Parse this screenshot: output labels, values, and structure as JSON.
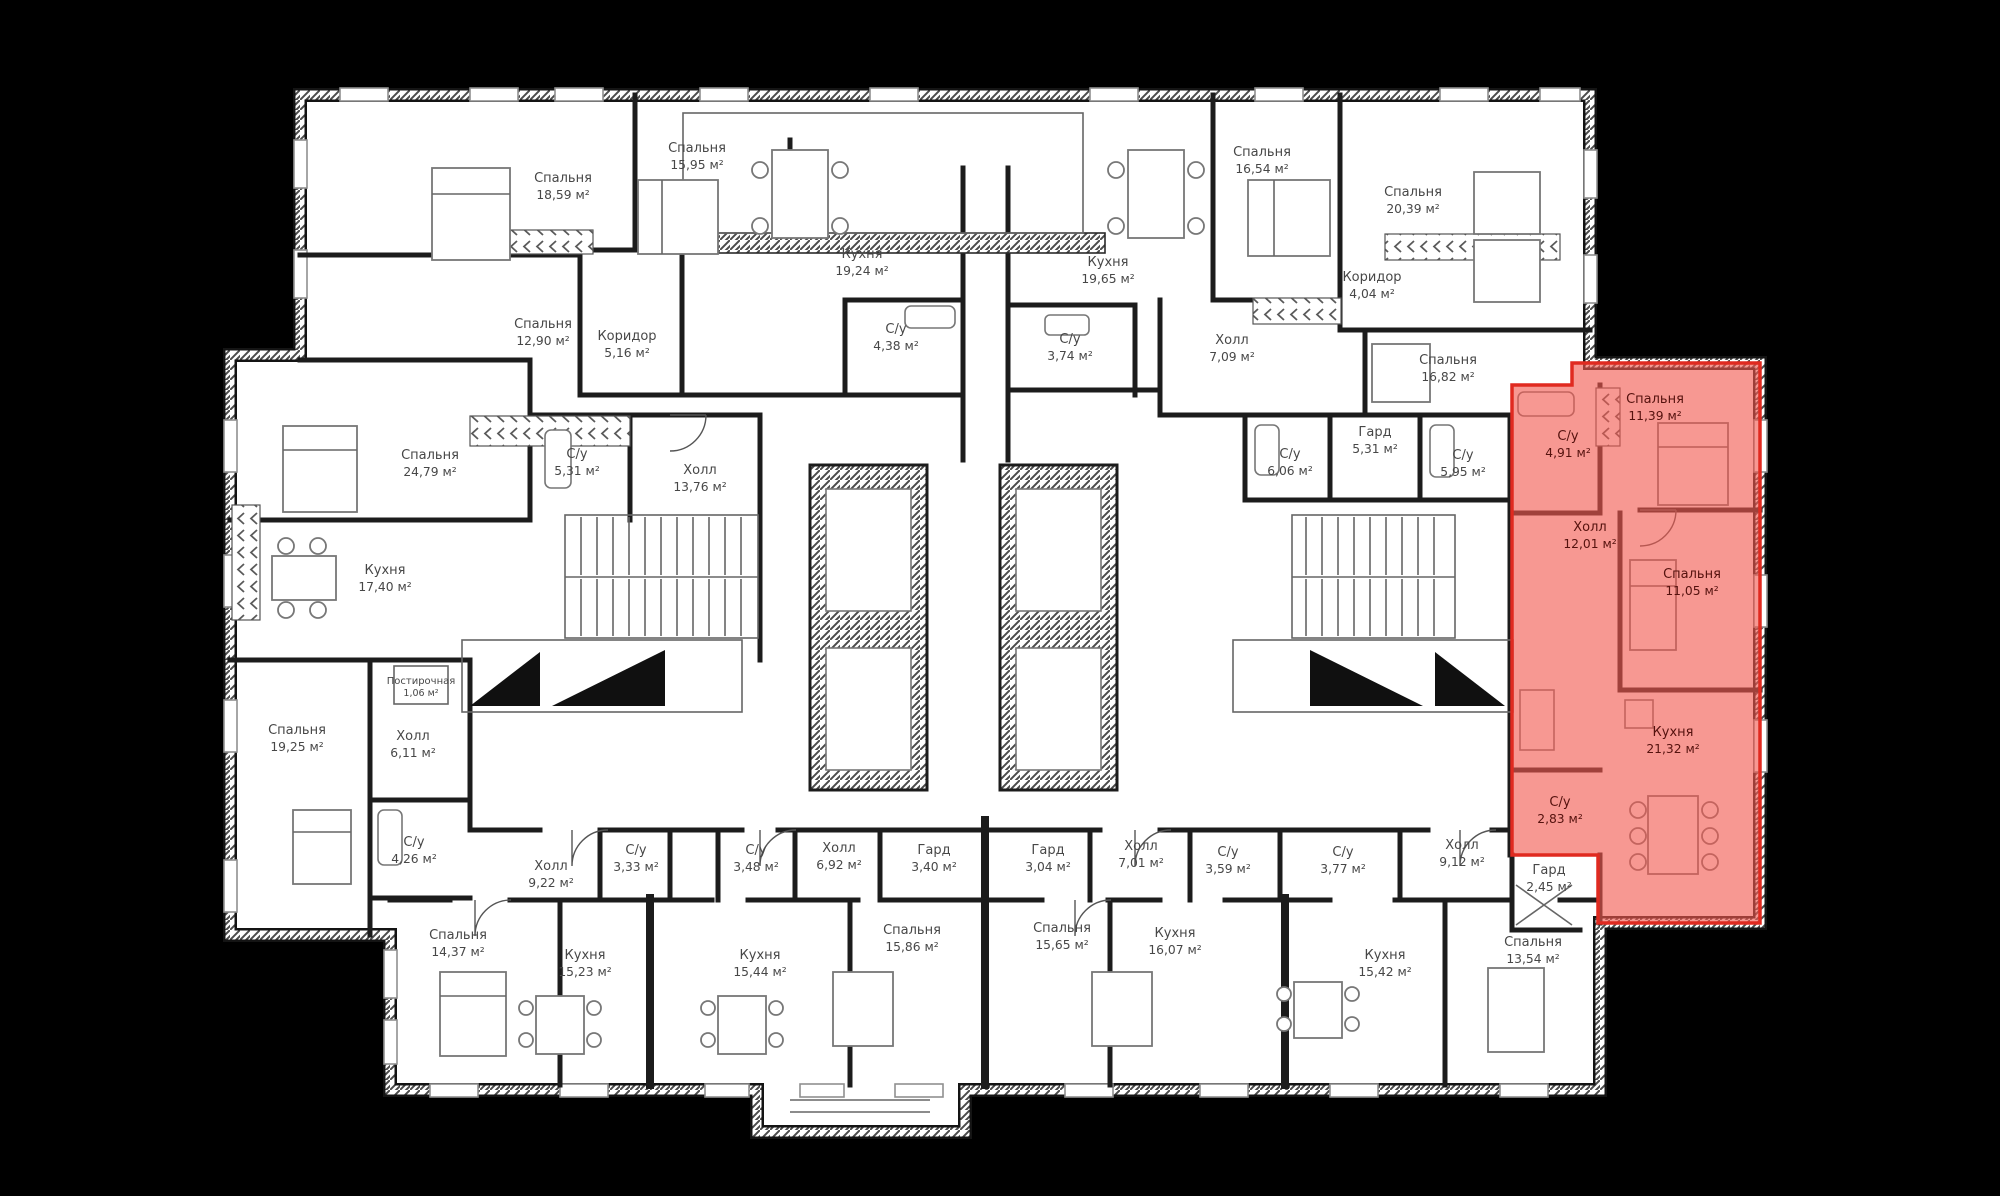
{
  "background": "#000000",
  "building_fill": "#ffffff",
  "wall_color": "#1c1c1c",
  "highlight": {
    "fill": "#f2584f",
    "border": "#e02a20"
  },
  "unit_suffix": "м²",
  "rooms": [
    {
      "name": "Спальня",
      "area": "18,59",
      "x": 563,
      "y": 182
    },
    {
      "name": "Спальня",
      "area": "15,95",
      "x": 697,
      "y": 152
    },
    {
      "name": "Кухня",
      "area": "19,24",
      "x": 862,
      "y": 258
    },
    {
      "name": "Спальня",
      "area": "12,90",
      "x": 543,
      "y": 328
    },
    {
      "name": "Коридор",
      "area": "5,16",
      "x": 627,
      "y": 340
    },
    {
      "name": "С/у",
      "area": "4,38",
      "x": 896,
      "y": 333
    },
    {
      "name": "С/у",
      "area": "3,74",
      "x": 1070,
      "y": 343
    },
    {
      "name": "Кухня",
      "area": "19,65",
      "x": 1108,
      "y": 266
    },
    {
      "name": "Спальня",
      "area": "16,54",
      "x": 1262,
      "y": 156
    },
    {
      "name": "Спальня",
      "area": "20,39",
      "x": 1413,
      "y": 196
    },
    {
      "name": "Коридор",
      "area": "4,04",
      "x": 1372,
      "y": 281
    },
    {
      "name": "Холл",
      "area": "7,09",
      "x": 1232,
      "y": 344
    },
    {
      "name": "Спальня",
      "area": "16,82",
      "x": 1448,
      "y": 364
    },
    {
      "name": "Спальня",
      "area": "24,79",
      "x": 430,
      "y": 459
    },
    {
      "name": "С/у",
      "area": "5,31",
      "x": 577,
      "y": 458
    },
    {
      "name": "Холл",
      "area": "13,76",
      "x": 700,
      "y": 474
    },
    {
      "name": "Кухня",
      "area": "17,40",
      "x": 385,
      "y": 574
    },
    {
      "name": "Гард",
      "area": "5,31",
      "x": 1375,
      "y": 436
    },
    {
      "name": "С/у",
      "area": "6,06",
      "x": 1290,
      "y": 458
    },
    {
      "name": "С/у",
      "area": "5,95",
      "x": 1463,
      "y": 459
    },
    {
      "name": "Спальня",
      "area": "19,25",
      "x": 297,
      "y": 734
    },
    {
      "name": "Холл",
      "area": "6,11",
      "x": 413,
      "y": 740
    },
    {
      "name": "Постирочная",
      "area": "1,06",
      "x": 421,
      "y": 684,
      "small": true
    },
    {
      "name": "С/у",
      "area": "4,26",
      "x": 414,
      "y": 846
    },
    {
      "name": "Холл",
      "area": "9,22",
      "x": 551,
      "y": 870
    },
    {
      "name": "С/у",
      "area": "3,33",
      "x": 636,
      "y": 854
    },
    {
      "name": "С/у",
      "area": "3,48",
      "x": 756,
      "y": 854
    },
    {
      "name": "Холл",
      "area": "6,92",
      "x": 839,
      "y": 852
    },
    {
      "name": "Гард",
      "area": "3,40",
      "x": 934,
      "y": 854
    },
    {
      "name": "Гард",
      "area": "3,04",
      "x": 1048,
      "y": 854
    },
    {
      "name": "Холл",
      "area": "7,01",
      "x": 1141,
      "y": 850
    },
    {
      "name": "С/у",
      "area": "3,59",
      "x": 1228,
      "y": 856
    },
    {
      "name": "С/у",
      "area": "3,77",
      "x": 1343,
      "y": 856
    },
    {
      "name": "Холл",
      "area": "9,12",
      "x": 1462,
      "y": 849
    },
    {
      "name": "Гард",
      "area": "2,45",
      "x": 1549,
      "y": 874
    },
    {
      "name": "Спальня",
      "area": "14,37",
      "x": 458,
      "y": 939
    },
    {
      "name": "Кухня",
      "area": "15,23",
      "x": 585,
      "y": 959
    },
    {
      "name": "Кухня",
      "area": "15,44",
      "x": 760,
      "y": 959
    },
    {
      "name": "Спальня",
      "area": "15,86",
      "x": 912,
      "y": 934
    },
    {
      "name": "Спальня",
      "area": "15,65",
      "x": 1062,
      "y": 932
    },
    {
      "name": "Кухня",
      "area": "16,07",
      "x": 1175,
      "y": 937
    },
    {
      "name": "Кухня",
      "area": "15,42",
      "x": 1385,
      "y": 959
    },
    {
      "name": "Спальня",
      "area": "13,54",
      "x": 1533,
      "y": 946
    },
    {
      "name": "Спальня",
      "area": "11,39",
      "x": 1655,
      "y": 403,
      "hl": true
    },
    {
      "name": "С/у",
      "area": "4,91",
      "x": 1568,
      "y": 440,
      "hl": true
    },
    {
      "name": "Холл",
      "area": "12,01",
      "x": 1590,
      "y": 531,
      "hl": true
    },
    {
      "name": "Спальня",
      "area": "11,05",
      "x": 1692,
      "y": 578,
      "hl": true
    },
    {
      "name": "Кухня",
      "area": "21,32",
      "x": 1673,
      "y": 736,
      "hl": true
    },
    {
      "name": "С/у",
      "area": "2,83",
      "x": 1560,
      "y": 806,
      "hl": true
    }
  ]
}
